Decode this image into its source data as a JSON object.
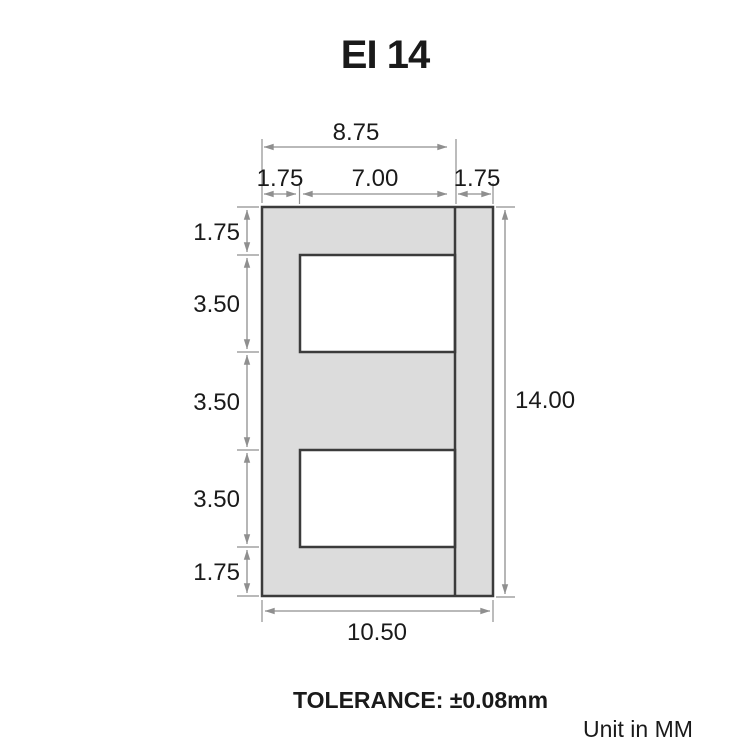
{
  "title": "EI 14",
  "dimensions": {
    "top": {
      "overall": "8.75",
      "left_leg": "1.75",
      "window": "7.00",
      "right_leg": "1.75"
    },
    "left": [
      "1.75",
      "3.50",
      "3.50",
      "3.50",
      "1.75"
    ],
    "height": "14.00",
    "width": "10.50"
  },
  "footer": {
    "tolerance": "TOLERANCE: ±0.08mm",
    "unit": "Unit in MM"
  },
  "colors": {
    "core_fill": "#dcdcdc",
    "outline": "#3b3b3b",
    "dimension_lines": "#8f8f8f",
    "text": "#1a1a1a",
    "background": "#ffffff"
  }
}
